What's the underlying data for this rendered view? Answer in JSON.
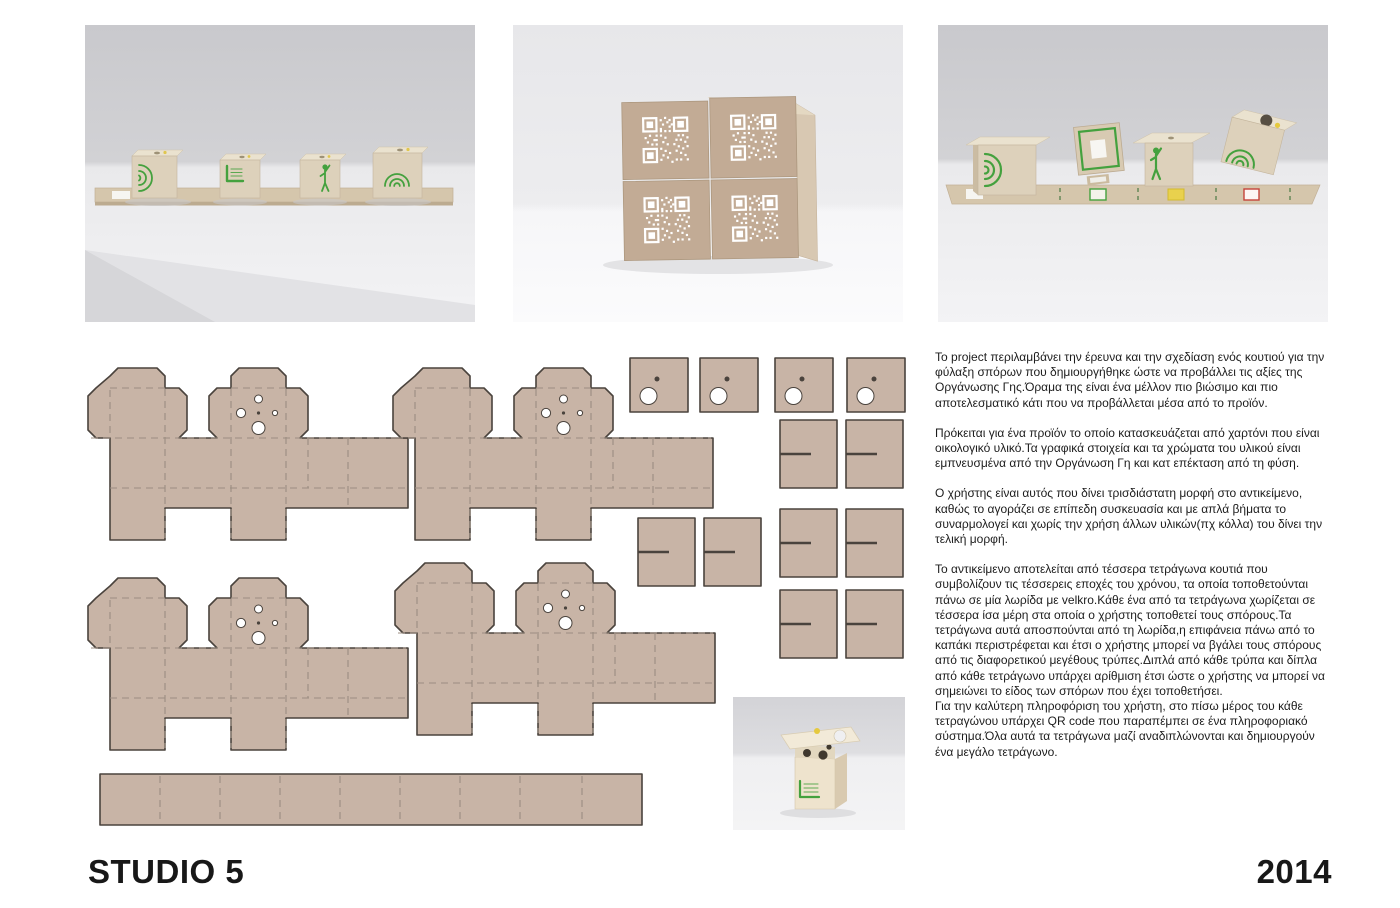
{
  "branding": {
    "studio_label": "STUDIO 5",
    "year_label": "2014"
  },
  "description": {
    "paragraphs": [
      "Το project περιλαμβάνει την έρευνα και την σχεδίαση ενός κουτιού για την φύλαξη σπόρων που δημιουργήθηκε ώστε να προβάλλει τις αξίες της Οργάνωσης Γης.Όραμα της είναι ένα μέλλον πιο βιώσιμο και πιο αποτελεσματικό κάτι που να προβάλλεται μέσα από το προϊόν.",
      "Πρόκειται για ένα προϊόν το οποίο κατασκευάζεται από χαρτόνι που είναι οικολογικό υλικό.Τα γραφικά στοιχεία και τα χρώματα του υλικού είναι εμπνευσμένα από την Οργάνωση Γη και κατ επέκταση από τη φύση.",
      "Ο χρήστης είναι αυτός που δίνει τρισδιάστατη μορφή στο αντικείμενο, καθώς το αγοράζει σε επίπεδη συσκευασία και με απλά βήματα το συναρμολογεί και χωρίς την χρήση άλλων υλικών(πχ κόλλα) του δίνει την τελική μορφή.",
      "Το αντικείμενο αποτελείται από τέσσερα τετράγωνα κουτιά που συμβολίζουν τις τέσσερεις εποχές του χρόνου, τα οποία τοποθετούνται πάνω σε μία λωρίδα με velkro.Κάθε ένα από τα τετράγωνα χωρίζεται σε τέσσερα ίσα μέρη στα οποία ο χρήστης τοποθετεί τους σπόρους.Τα τετράγωνα αυτά αποσπούνται από τη λωρίδα,η επιφάνεια πάνω από το καπάκι περιστρέφεται και έτσι ο χρήστης μπορεί να βγάλει τους σπόρους από τις διαφορετικού μεγέθους τρύπες.Διπλά από κάθε τρύπα και δίπλα από κάθε τετράγωνο υπάρχει αρίθμιση έτσι ώστε ο χρήστης να μπορεί να σημειώνει το είδος των σπόρων που έχει τοποθετήσει.",
      "Για την καλύτερη πληροφόριση του χρήστη, στο πίσω μέρος του κάθε τετραγώνου υπάρχει QR code που παραπέμπει σε ένα πληροφοριακό σύστημα.Όλα αυτά τα τετράγωνα μαζί αναδιπλώνονται και δημιουργούν ένα μεγάλο τετράγωνο."
    ]
  },
  "icons": {
    "spiral": "concentric-arcs-icon",
    "figure": "person-icon",
    "logo": "organosi-gi-logo-icon",
    "qr": "qr-code-icon"
  },
  "colors": {
    "cardboard": "#c8b4a6",
    "outline": "#4a433d",
    "fold": "#9b8d81",
    "green": "#44a13e",
    "yellow": "#e3c43c",
    "red": "#c5443a",
    "qrface": "#c2ab95",
    "wall": "#c9c9cd",
    "table": "#f3f3f5"
  }
}
